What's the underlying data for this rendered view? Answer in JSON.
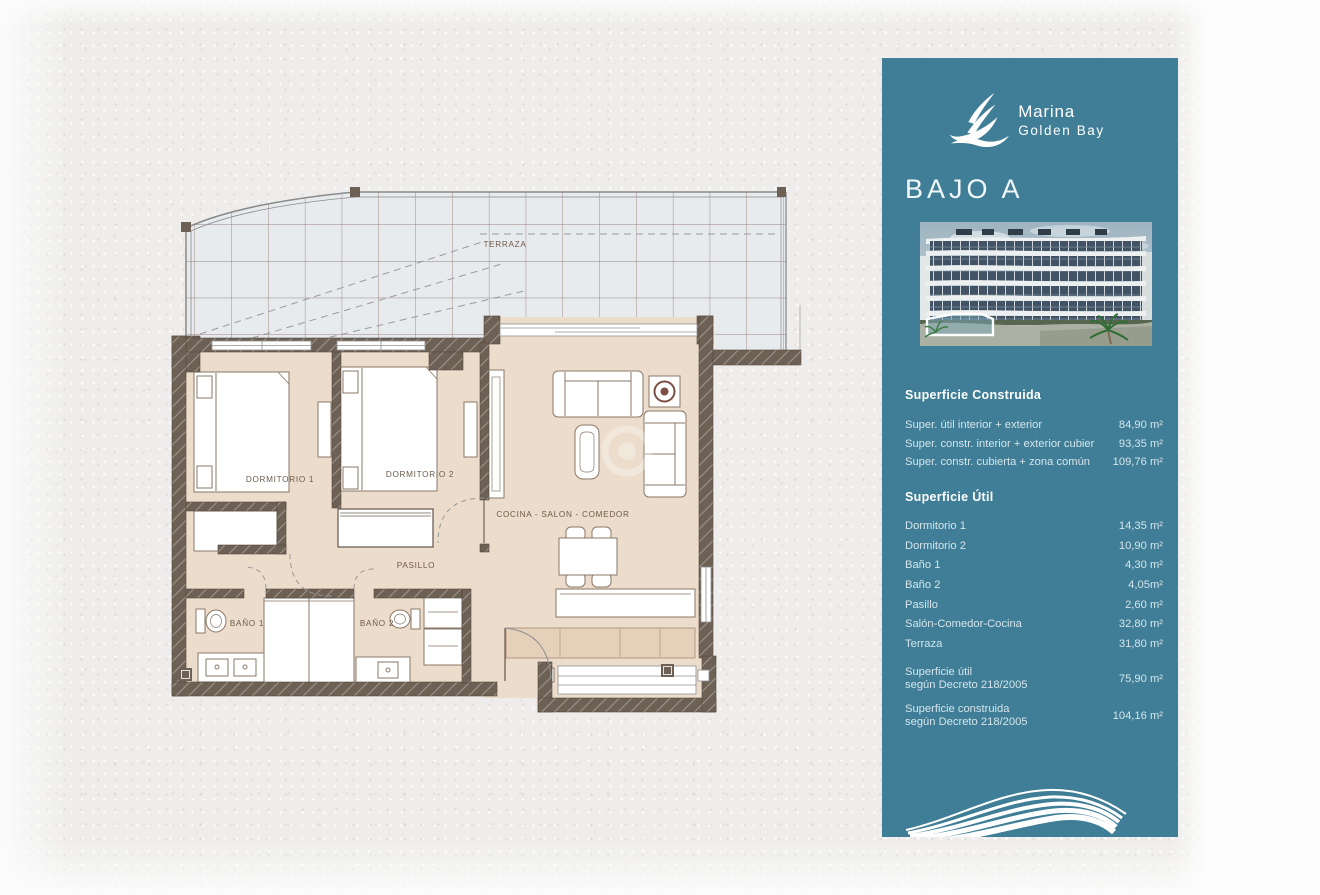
{
  "colors": {
    "sidebar_bg": "#3f7e96",
    "heading_text": "#ffffff",
    "body_text": "#d5e5ec",
    "wall": "#6d6054",
    "floor": "#ecdccb",
    "terrace_tile": "#e8ebee",
    "terrace_grid": "#86655c",
    "plan_label": "#6f5b49"
  },
  "sidebar": {
    "brand": {
      "line1": "Marina",
      "line2": "Golden Bay"
    },
    "title": "BAJO A",
    "sections": [
      {
        "heading": "Superficie Construida",
        "rows": [
          {
            "label": "Super. útil interior + exterior",
            "value": "84,90 m²"
          },
          {
            "label": "Super. constr. interior + exterior cubier",
            "value": "93,35 m²"
          },
          {
            "label": "Super. constr. cubierta + zona común",
            "value": "109,76 m²"
          }
        ]
      },
      {
        "heading": "Superficie Útil",
        "rows": [
          {
            "label": "Dormitorio 1",
            "value": "14,35 m²"
          },
          {
            "label": "Dormitorio 2",
            "value": "10,90 m²"
          },
          {
            "label": "Baño 1",
            "value": "4,30 m²"
          },
          {
            "label": "Baño 2",
            "value": "4,05m²"
          },
          {
            "label": "Pasillo",
            "value": "2,60 m²"
          },
          {
            "label": "Salón-Comedor-Cocina",
            "value": "32,80 m²"
          },
          {
            "label": "Terraza",
            "value": "31,80 m²"
          }
        ]
      }
    ],
    "totals": [
      {
        "line1": "Superficie útil",
        "line2": "según Decreto 218/2005",
        "value": "75,90 m²"
      },
      {
        "line1": "Superficie construida",
        "line2": "según Decreto 218/2005",
        "value": "104,16 m²"
      }
    ]
  },
  "plan": {
    "labels": {
      "terraza": "TERRAZA",
      "dormitorio1": "DORMITORIO 1",
      "dormitorio2": "DORMITORIO 2",
      "cocina": "COCINA - SALON - COMEDOR",
      "pasillo": "PASILLO",
      "bano1": "BAÑO 1",
      "bano2": "BAÑO 2"
    }
  }
}
